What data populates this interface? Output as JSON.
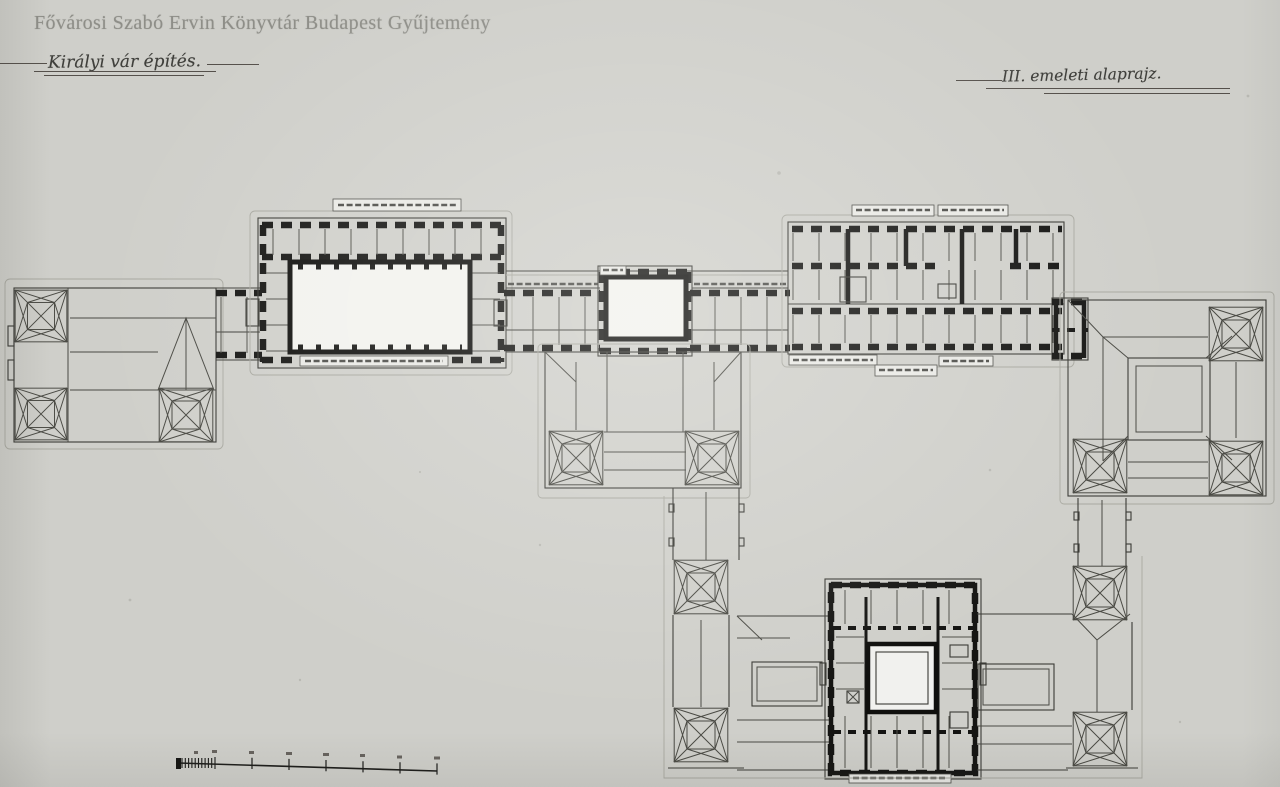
{
  "watermark": {
    "text": "Fővárosi Szabó Ervin Könyvtár Budapest Gyűjtemény"
  },
  "titles": {
    "left": "Királyi vár építés.",
    "right": "III. emeleti alaprajz."
  },
  "colors": {
    "paper": "#e8e8e4",
    "ink": "#141412",
    "drawing_line": "#3b3b36",
    "faint_line": "#a8a8a0",
    "watermark_gray": "#8e8e88",
    "handwriting": "#3f3f3b"
  },
  "scale_bar": {
    "major_ticks": 7,
    "subdivided_left_segment": true
  }
}
